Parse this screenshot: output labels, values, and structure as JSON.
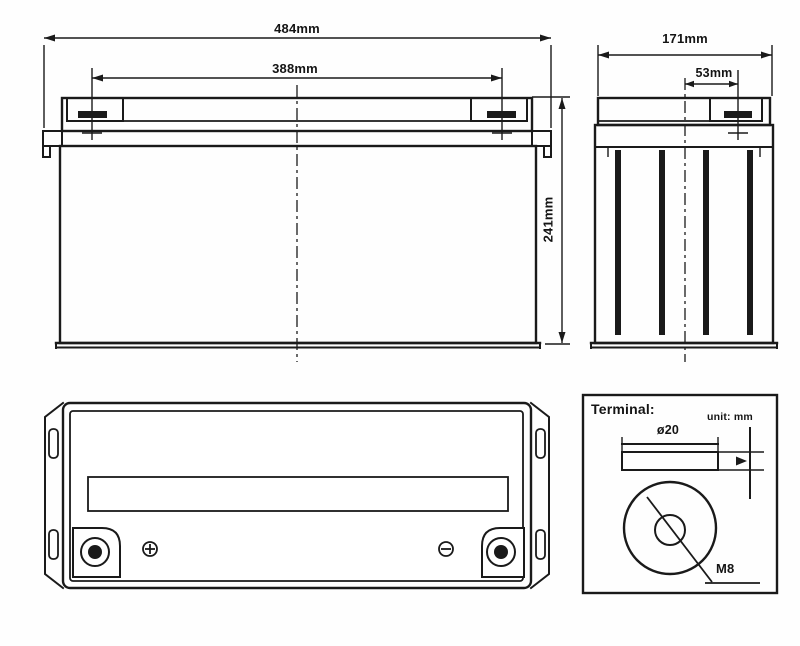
{
  "drawing": {
    "type": "battery dimensional outline drawing",
    "views": [
      "front view",
      "side view",
      "top view",
      "terminal detail"
    ],
    "labels": {
      "front_width": "484mm",
      "front_terminal_spacing": "388mm",
      "front_height": "241mm",
      "side_width": "171mm",
      "side_terminal_offset": "53mm",
      "terminal_title": "Terminal:",
      "unit_note": "unit: mm",
      "terminal_diameter": "ø20",
      "terminal_thread": "M8"
    },
    "dimensions": {
      "overall_length_mm": 484,
      "terminal_spacing_mm": 388,
      "height_mm": 241,
      "overall_width_mm": 171,
      "terminal_offset_from_center_mm": 53,
      "terminal_diameter_mm": 20,
      "terminal_thread": "M8"
    }
  }
}
